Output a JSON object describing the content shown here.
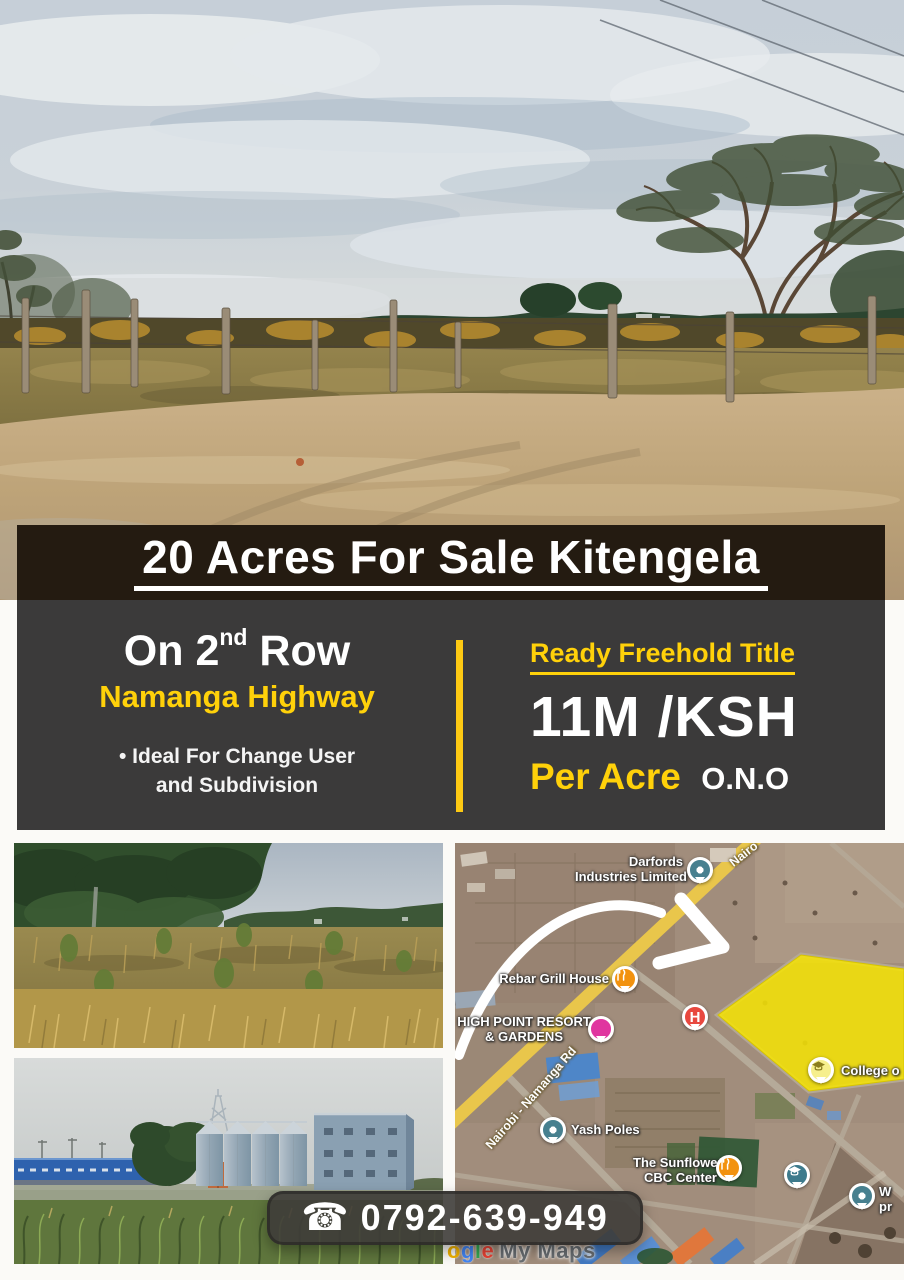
{
  "banner": {
    "title": "20 Acres For Sale Kitengela"
  },
  "panel": {
    "row": {
      "pre": "On 2",
      "sup": "nd",
      "post": " Row"
    },
    "highway": "Namanga Highway",
    "bullet": "•",
    "feature_line1": "Ideal For Change User",
    "feature_line2": "and Subdivision",
    "freehold": "Ready Freehold Title",
    "price": "11M /KSH",
    "per_acre": "Per Acre",
    "ono": "O.N.O"
  },
  "contact": {
    "icon": "☎",
    "number": "0792-639-949"
  },
  "map": {
    "labels": {
      "darfords1": "Darfords",
      "darfords2": "Industries Limited",
      "road_top": "Nairo",
      "road_main": "Nairobi - Namanga Rd",
      "rebar": "Rebar Grill House",
      "highpoint1": "HIGH POINT RESORT",
      "highpoint2": "& GARDENS",
      "hospital": "H",
      "yash": "Yash Poles",
      "sunflower1": "The Sunflower",
      "sunflower2": "CBC Center",
      "college": "College o",
      "west1": "W",
      "west2": "pr"
    },
    "watermark": {
      "o": "o",
      "g": "g",
      "l": "l",
      "e": "e",
      "rest": "My Maps"
    }
  },
  "colors": {
    "accent_yellow": "#ffd10a",
    "panel_gray": "#3b3a3a",
    "banner_brown": "#241b11",
    "plot_yellow": "#f6e403",
    "road_yellow": "#e9c64b"
  }
}
